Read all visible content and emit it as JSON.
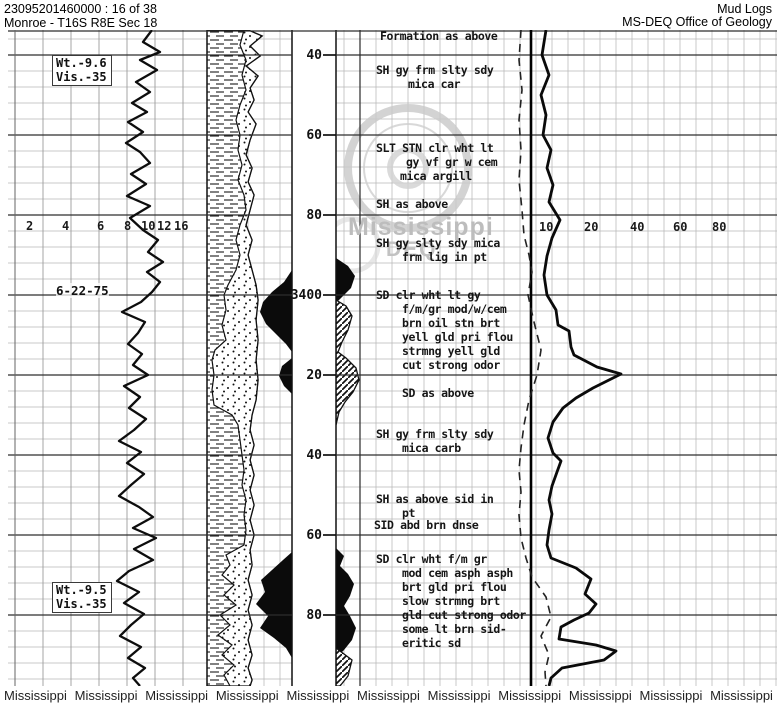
{
  "header": {
    "doc_number": "23095201460000 : 16 of 38",
    "location": "Monroe - T16S R8E Sec 18",
    "log_type": "Mud Logs",
    "agency": "MS-DEQ Office of Geology"
  },
  "left_track": {
    "mud_check_top": {
      "weight": "Wt.-9.6",
      "viscosity": "Vis.-35"
    },
    "date_annotation": "6-22-75",
    "mud_check_bottom": {
      "weight": "Wt.-9.5",
      "viscosity": "Vis.-35"
    },
    "scale_labels": [
      "2",
      "4",
      "6",
      "8",
      "10",
      "12",
      "16"
    ]
  },
  "depth_track": {
    "labels": [
      "40",
      "60",
      "80",
      "3400",
      "20",
      "40",
      "60",
      "80"
    ]
  },
  "right_track": {
    "scale_labels": [
      "10",
      "20",
      "40",
      "60",
      "80"
    ]
  },
  "descriptions": [
    {
      "lines": [
        "Formation as above"
      ]
    },
    {
      "lines": [
        "SH gy frm slty sdy",
        "mica car"
      ]
    },
    {
      "lines": [
        "SLT STN clr wht lt",
        "gy vf gr w cem",
        "mica argill"
      ]
    },
    {
      "lines": [
        "SH as above"
      ]
    },
    {
      "lines": [
        "SH gy slty sdy mica",
        "frm lig in pt"
      ]
    },
    {
      "lines": [
        "SD clr wht lt gy",
        "f/m/gr mod/w/cem",
        "brn oil stn brt",
        "yell gld pri flou",
        "strmng yell gld",
        "cut strong odor"
      ]
    },
    {
      "lines": [
        "SD as above"
      ]
    },
    {
      "lines": [
        "SH gy frm slty sdy",
        "mica carb"
      ]
    },
    {
      "lines": [
        "SH as above sid in",
        "pt"
      ]
    },
    {
      "lines": [
        "SID abd brn dnse"
      ]
    },
    {
      "lines": [
        "SD clr wht f/m gr",
        "mod cem asph asph",
        "brt gld pri flou",
        "slow strmng brt",
        "gld cut strong odor",
        "some lt brn sid-",
        "eritic sd"
      ]
    }
  ],
  "watermark": {
    "line1": "Mississippi",
    "line2": "DEQ"
  },
  "footer": {
    "items": [
      "Mississippi",
      "Mississippi",
      "Mississippi",
      "Mississippi",
      "Mississippi",
      "Mississippi",
      "Mississippi",
      "Mississippi",
      "Mississippi",
      "Mississippi",
      "Mississippi"
    ]
  }
}
